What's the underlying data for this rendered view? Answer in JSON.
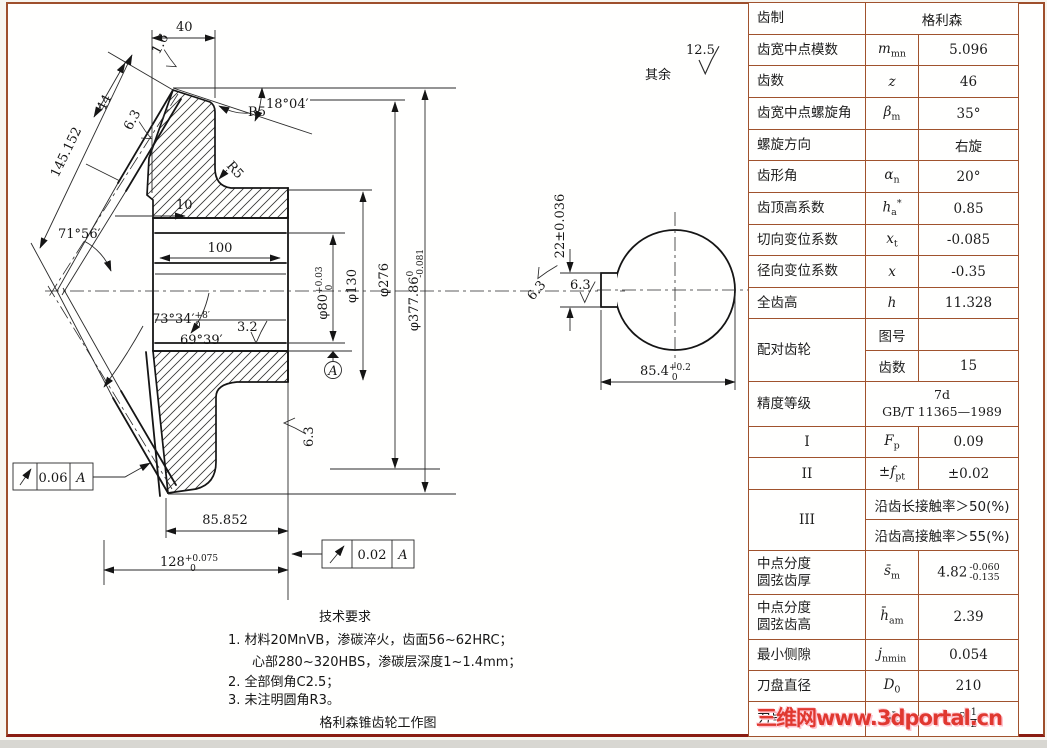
{
  "drawing": {
    "corner_note": {
      "label": "其余",
      "value": "12.5"
    },
    "main": {
      "dim40": "40",
      "rough16": "1.6",
      "dim44": "44",
      "rough63": "6.3",
      "dim145": "145.152",
      "angle18": "18°04′",
      "r5": "R5",
      "dim10": "10",
      "dim100": "100",
      "angle71": "71°56′",
      "angle73": "73°34′",
      "angle73sup": "+8′",
      "angle73sub": "0",
      "angle69": "69°39′",
      "rough32": "3.2",
      "dia80": "φ80",
      "dia80sup": "+0.03",
      "dia80sub": "0",
      "dia130": "φ130",
      "dia276": "φ276",
      "dia377": "φ377.86",
      "dia377sup": "0",
      "dia377sub": "-0.081",
      "dim85852": "85.852",
      "dim128": "128",
      "dim128sup": "+0.075",
      "dim128sub": "0",
      "runout1_value": "0.06",
      "runout1_datum": "A",
      "runout2_value": "0.02",
      "runout2_datum": "A",
      "rough63b": "6.3",
      "datum_label": "A"
    },
    "side": {
      "dim22": "22±0.036",
      "rough63a": "6.3",
      "rough63b": "6.3",
      "dim854": "85.4",
      "dim854sup": "+0.2",
      "dim854sub": "0"
    },
    "tech": {
      "title": "技术要求",
      "l1": "1.  材料20MnVB，渗碳淬火，齿面56~62HRC；",
      "l2": "心部280~320HBS，渗碳层深度1~1.4mm；",
      "l3": "2.  全部倒角C2.5；",
      "l4": "3.  未注明圆角R3。",
      "caption": "格利森锥齿轮工作图"
    }
  },
  "table": {
    "rows": [
      {
        "label": "齿制",
        "value": "格利森"
      },
      {
        "label": "齿宽中点模数",
        "sym": "m",
        "sub": "mn",
        "value": "5.096"
      },
      {
        "label": "齿数",
        "sym": "z",
        "sub": "",
        "value": "46"
      },
      {
        "label": "齿宽中点螺旋角",
        "sym": "β",
        "sub": "m",
        "value": "35°"
      },
      {
        "label": "螺旋方向",
        "sym": "",
        "value": "右旋"
      },
      {
        "label": "齿形角",
        "sym": "α",
        "sub": "n",
        "value": "20°"
      },
      {
        "label": "齿顶高系数",
        "sym": "h",
        "sub": "a",
        "sup": "*",
        "value": "0.85"
      },
      {
        "label": "切向变位系数",
        "sym": "x",
        "sub": "t",
        "value": "-0.085"
      },
      {
        "label": "径向变位系数",
        "sym": "x",
        "sub": "",
        "value": "-0.35"
      },
      {
        "label": "全齿高",
        "sym": "h",
        "sub": "",
        "value": "11.328"
      },
      {
        "label": "配对齿轮",
        "sub1_label": "图号",
        "sub1_value": "",
        "sub2_label": "齿数",
        "sub2_value": "15"
      },
      {
        "label": "精度等级",
        "line1": "7d",
        "line2": "GB/T 11365—1989"
      },
      {
        "label": "I",
        "sym": "F",
        "sub": "p",
        "value": "0.09"
      },
      {
        "label": "II",
        "sym": "±f",
        "sub": "pt",
        "value": "±0.02"
      },
      {
        "label": "III",
        "line1": "沿齿长接触率＞50(%)",
        "line2": "沿齿高接触率＞55(%)"
      },
      {
        "label": "中点分度\n圆弦齿厚",
        "sym": "s̄",
        "sub": "m",
        "value": "4.82",
        "tol_up": "-0.060",
        "tol_dn": "-0.135"
      },
      {
        "label": "中点分度\n圆弦齿高",
        "sym": "h̄",
        "sub": "am",
        "value": "2.39"
      },
      {
        "label": "最小侧隙",
        "sym": "j",
        "sub": "nmin",
        "value": "0.054"
      },
      {
        "label": "刀盘直径",
        "sym": "D",
        "sub": "0",
        "value": "210"
      },
      {
        "label": "刀号",
        "sym": "N",
        "sub": "o",
        "value": "8",
        "frac_n": "1",
        "frac_d": "2"
      }
    ]
  },
  "watermark": {
    "text": "三维网www.3dportal.cn"
  }
}
